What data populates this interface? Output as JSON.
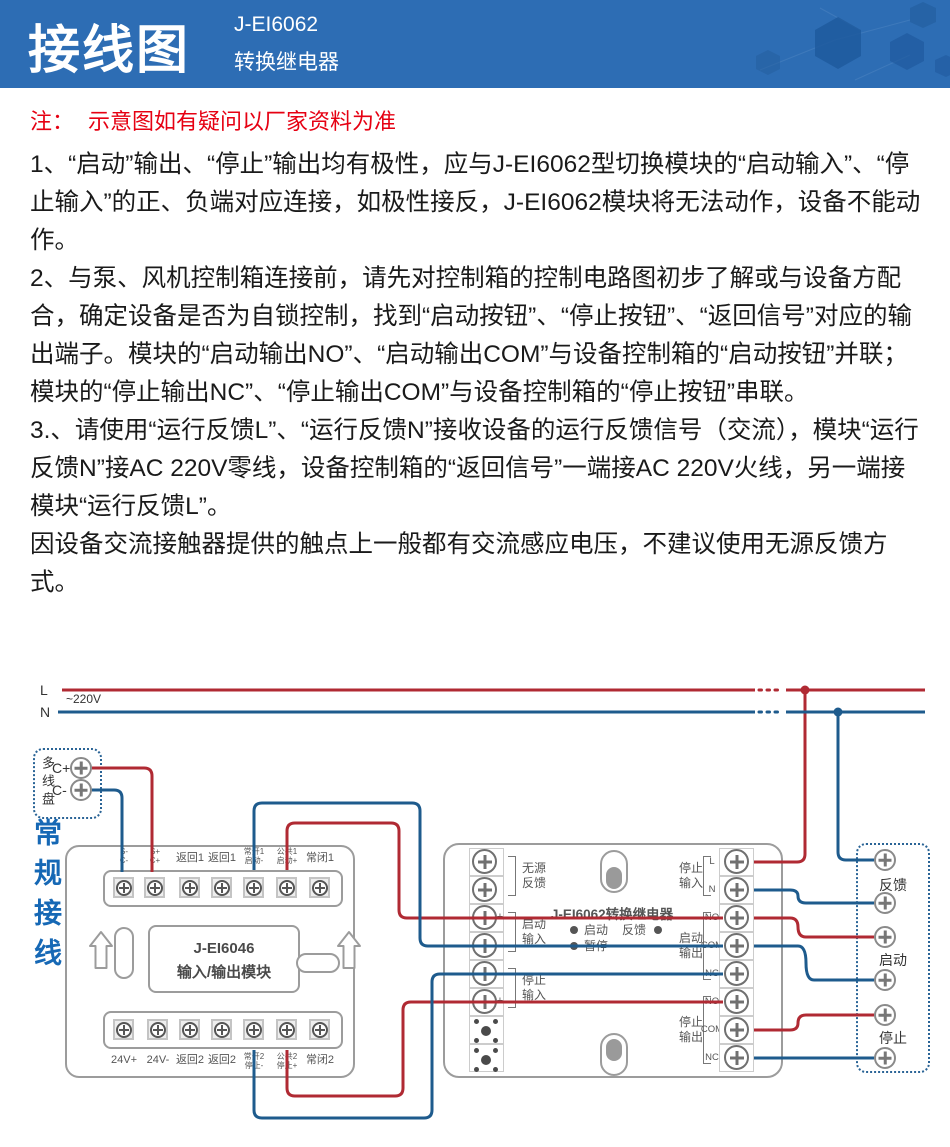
{
  "header": {
    "title": "接线图",
    "model": "J-EI6062",
    "subtitle": "转换继电器"
  },
  "note": {
    "prefix": "注：",
    "text": "示意图如有疑问以厂家资料为准"
  },
  "paragraphs": {
    "p1": "1、“启动”输出、“停止”输出均有极性，应与J-EI6062型切换模块的“启动输入”、“停止输入”的正、负端对应连接，如极性接反，J-EI6062模块将无法动作，设备不能动作。",
    "p2": "2、与泵、风机控制箱连接前，请先对控制箱的控制电路图初步了解或与设备方配合，确定设备是否为自锁控制，找到“启动按钮”、“停止按钮”、“返回信号”对应的输出端子。模块的“启动输出NO”、“启动输出COM”与设备控制箱的“启动按钮”并联；模块的“停止输出NC”、“停止输出COM”与设备控制箱的“停止按钮”串联。",
    "p3": "3.、请使用“运行反馈L”、“运行反馈N”接收设备的运行反馈信号（交流），模块“运行反馈N”接AC 220V零线，设备控制箱的“返回信号”一端接AC 220V火线，另一端接模块“运行反馈L”。",
    "p4": "因设备交流接触器提供的触点上一般都有交流感应电压，不建议使用无源反馈方式。"
  },
  "diagram": {
    "power": {
      "l_label": "L",
      "n_label": "N",
      "voltage": "~220V"
    },
    "loop_panel": {
      "name": "多线盘",
      "c_plus": "C+",
      "c_minus": "C-"
    },
    "side_label": "常规接线",
    "module1": {
      "model": "J-EI6046",
      "name": "输入/输出模块",
      "top_terminals": [
        {
          "l1": "S-",
          "l2": "C-"
        },
        {
          "l1": "S+",
          "l2": "C+"
        },
        {
          "l1": "返回1",
          "l2": ""
        },
        {
          "l1": "返回1",
          "l2": ""
        },
        {
          "l1": "常开1",
          "l2": "启动-"
        },
        {
          "l1": "公共1",
          "l2": "启动+"
        },
        {
          "l1": "常闭1",
          "l2": ""
        }
      ],
      "bottom_terminals": [
        {
          "l1": "24V+",
          "l2": ""
        },
        {
          "l1": "24V-",
          "l2": ""
        },
        {
          "l1": "返回2",
          "l2": ""
        },
        {
          "l1": "返回2",
          "l2": ""
        },
        {
          "l1": "常开2",
          "l2": "停止-"
        },
        {
          "l1": "公共2",
          "l2": "停止+"
        },
        {
          "l1": "常闭2",
          "l2": ""
        }
      ]
    },
    "module2": {
      "title": "J-EI6062转换继电器",
      "leds": {
        "start": "启动",
        "feedback": "反馈",
        "pause": "暂停"
      },
      "left_groups": [
        {
          "l1": "无源",
          "l2": "反馈",
          "sign_top": "",
          "sign_bottom": ""
        },
        {
          "l1": "启动",
          "l2": "输入",
          "sign_top": "+",
          "sign_bottom": "-"
        },
        {
          "l1": "停止",
          "l2": "输入",
          "sign_top": "-",
          "sign_bottom": "+"
        }
      ],
      "right_groups": [
        {
          "l1": "停止",
          "l2": "输入",
          "pins": [
            "L",
            "N"
          ]
        },
        {
          "l1": "启动",
          "l2": "输出",
          "pins": [
            "NO",
            "COM",
            "NC"
          ]
        },
        {
          "l1": "停止",
          "l2": "输出",
          "pins": [
            "NO",
            "COM",
            "NC"
          ]
        }
      ]
    },
    "feedback_box": {
      "labels": [
        "反馈",
        "启动",
        "停止"
      ]
    },
    "colors": {
      "wire_live": "#b02a33",
      "wire_neutral": "#1e5b8d",
      "accent_blue": "#1668b5",
      "header_blue": "#2d6db4",
      "note_red": "#e60012"
    }
  }
}
